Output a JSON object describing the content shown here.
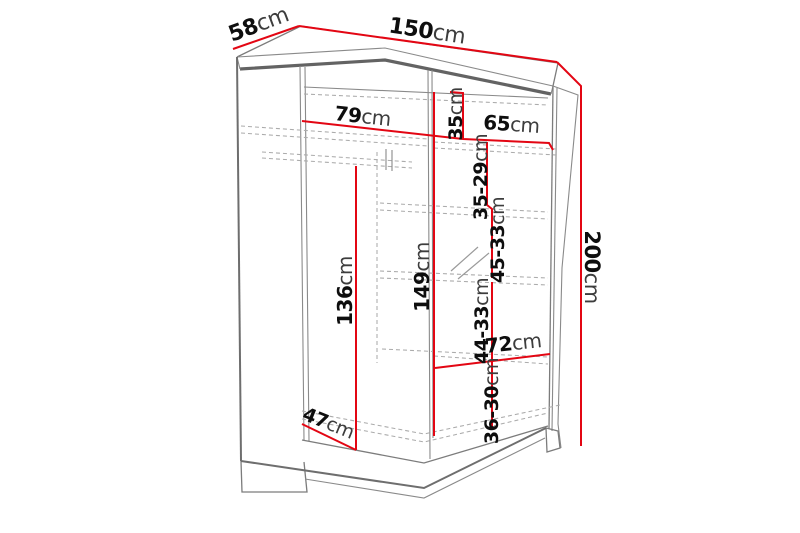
{
  "title": "Wardrobe dimension diagram",
  "colors": {
    "dimension_red": "#e30613",
    "structure_gray": "#7c7c7c",
    "background": "#ffffff"
  },
  "dimensions": {
    "top_depth": {
      "value": "58",
      "unit": "cm"
    },
    "top_width": {
      "value": "150",
      "unit": "cm"
    },
    "right_height": {
      "value": "200",
      "unit": "cm"
    },
    "left_section_width": {
      "value": "79",
      "unit": "cm"
    },
    "top_compartment_height": {
      "value": "35",
      "unit": "cm"
    },
    "right_section_width": {
      "value": "65",
      "unit": "cm"
    },
    "right_shelf_space_1": {
      "value": "35-29",
      "unit": "cm"
    },
    "right_shelf_space_2": {
      "value": "45-33",
      "unit": "cm"
    },
    "left_hanging_height": {
      "value": "136",
      "unit": "cm"
    },
    "center_divider_height": {
      "value": "149",
      "unit": "cm"
    },
    "right_shelf_space_3": {
      "value": "44-33",
      "unit": "cm"
    },
    "bottom_section_width": {
      "value": "72",
      "unit": "cm"
    },
    "right_shelf_space_4": {
      "value": "36-30",
      "unit": "cm"
    },
    "bottom_floor_depth": {
      "value": "47",
      "unit": "cm"
    }
  }
}
